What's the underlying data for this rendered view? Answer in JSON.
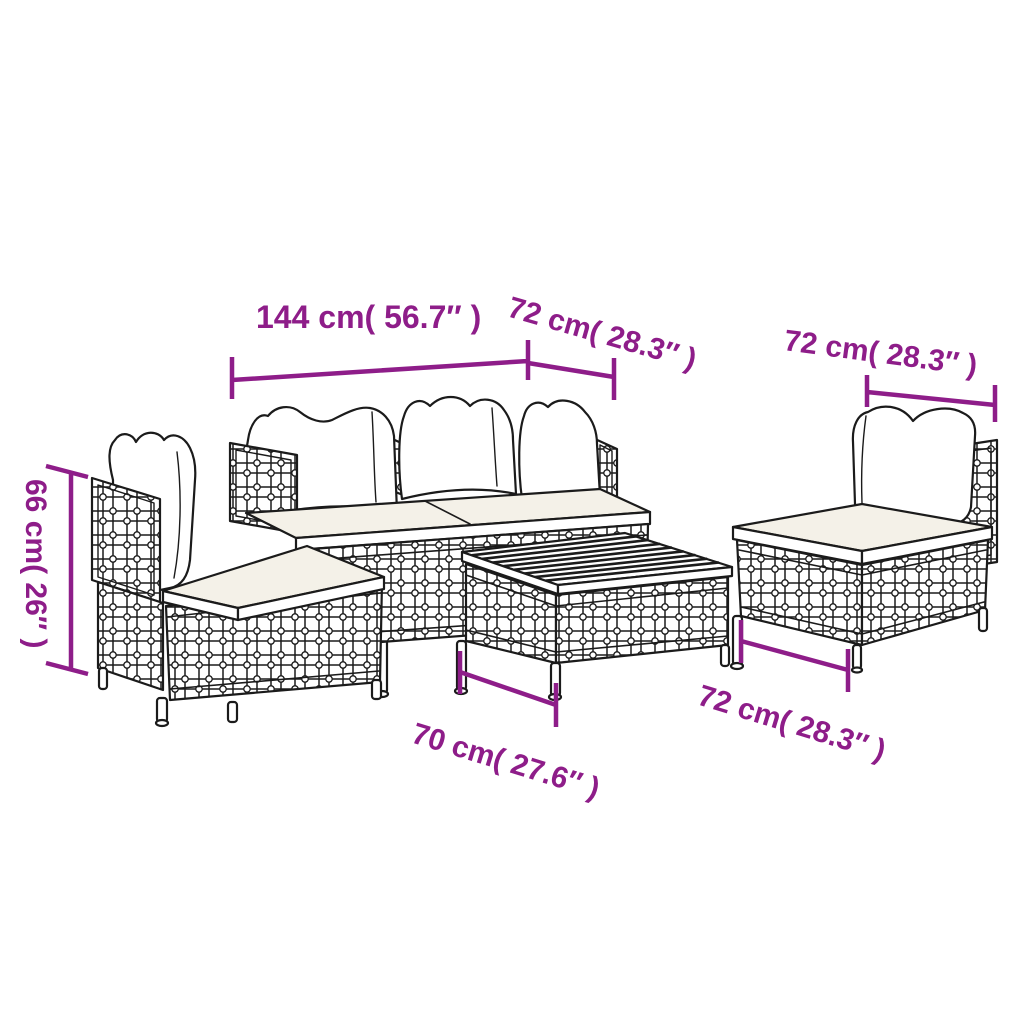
{
  "figure": {
    "alt": "Line drawing of a 5 piece poly rattan garden lounge set with cushions and dimension arrows"
  },
  "colors": {
    "accent": "#8E1D89",
    "line": "#1b1b1b",
    "cushion_top": "#F4F1E8",
    "background": "#ffffff"
  },
  "labels": {
    "sofa_width": "144 cm( 56.7″ )",
    "sofa_depth": "72 cm( 28.3″ )",
    "chair_width": "72 cm( 28.3″ )",
    "height": "66 cm( 26″ )",
    "table_width": "70 cm( 27.6″ )",
    "chair_depth": "72 cm( 28.3″ )"
  }
}
